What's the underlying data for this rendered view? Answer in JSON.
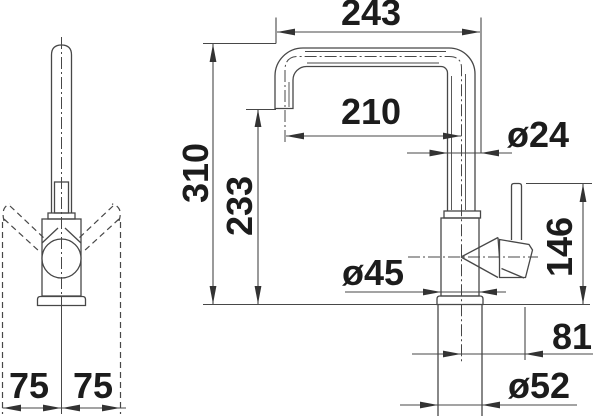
{
  "colors": {
    "background": "#ffffff",
    "line": "#474747",
    "text": "#1c1c1c"
  },
  "drawing": {
    "type": "technical-dimension-drawing",
    "subject": "kitchen-faucet",
    "front_view": {
      "swivel_left": "75",
      "swivel_right": "75"
    },
    "side_view": {
      "overall_width": "243",
      "spout_reach": "210",
      "spout_tube_diameter": "ø24",
      "overall_height": "310",
      "spout_outlet_height": "233",
      "body_diameter": "ø45",
      "lever_height": "146",
      "handle_projection": "81",
      "base_diameter": "ø52"
    }
  }
}
